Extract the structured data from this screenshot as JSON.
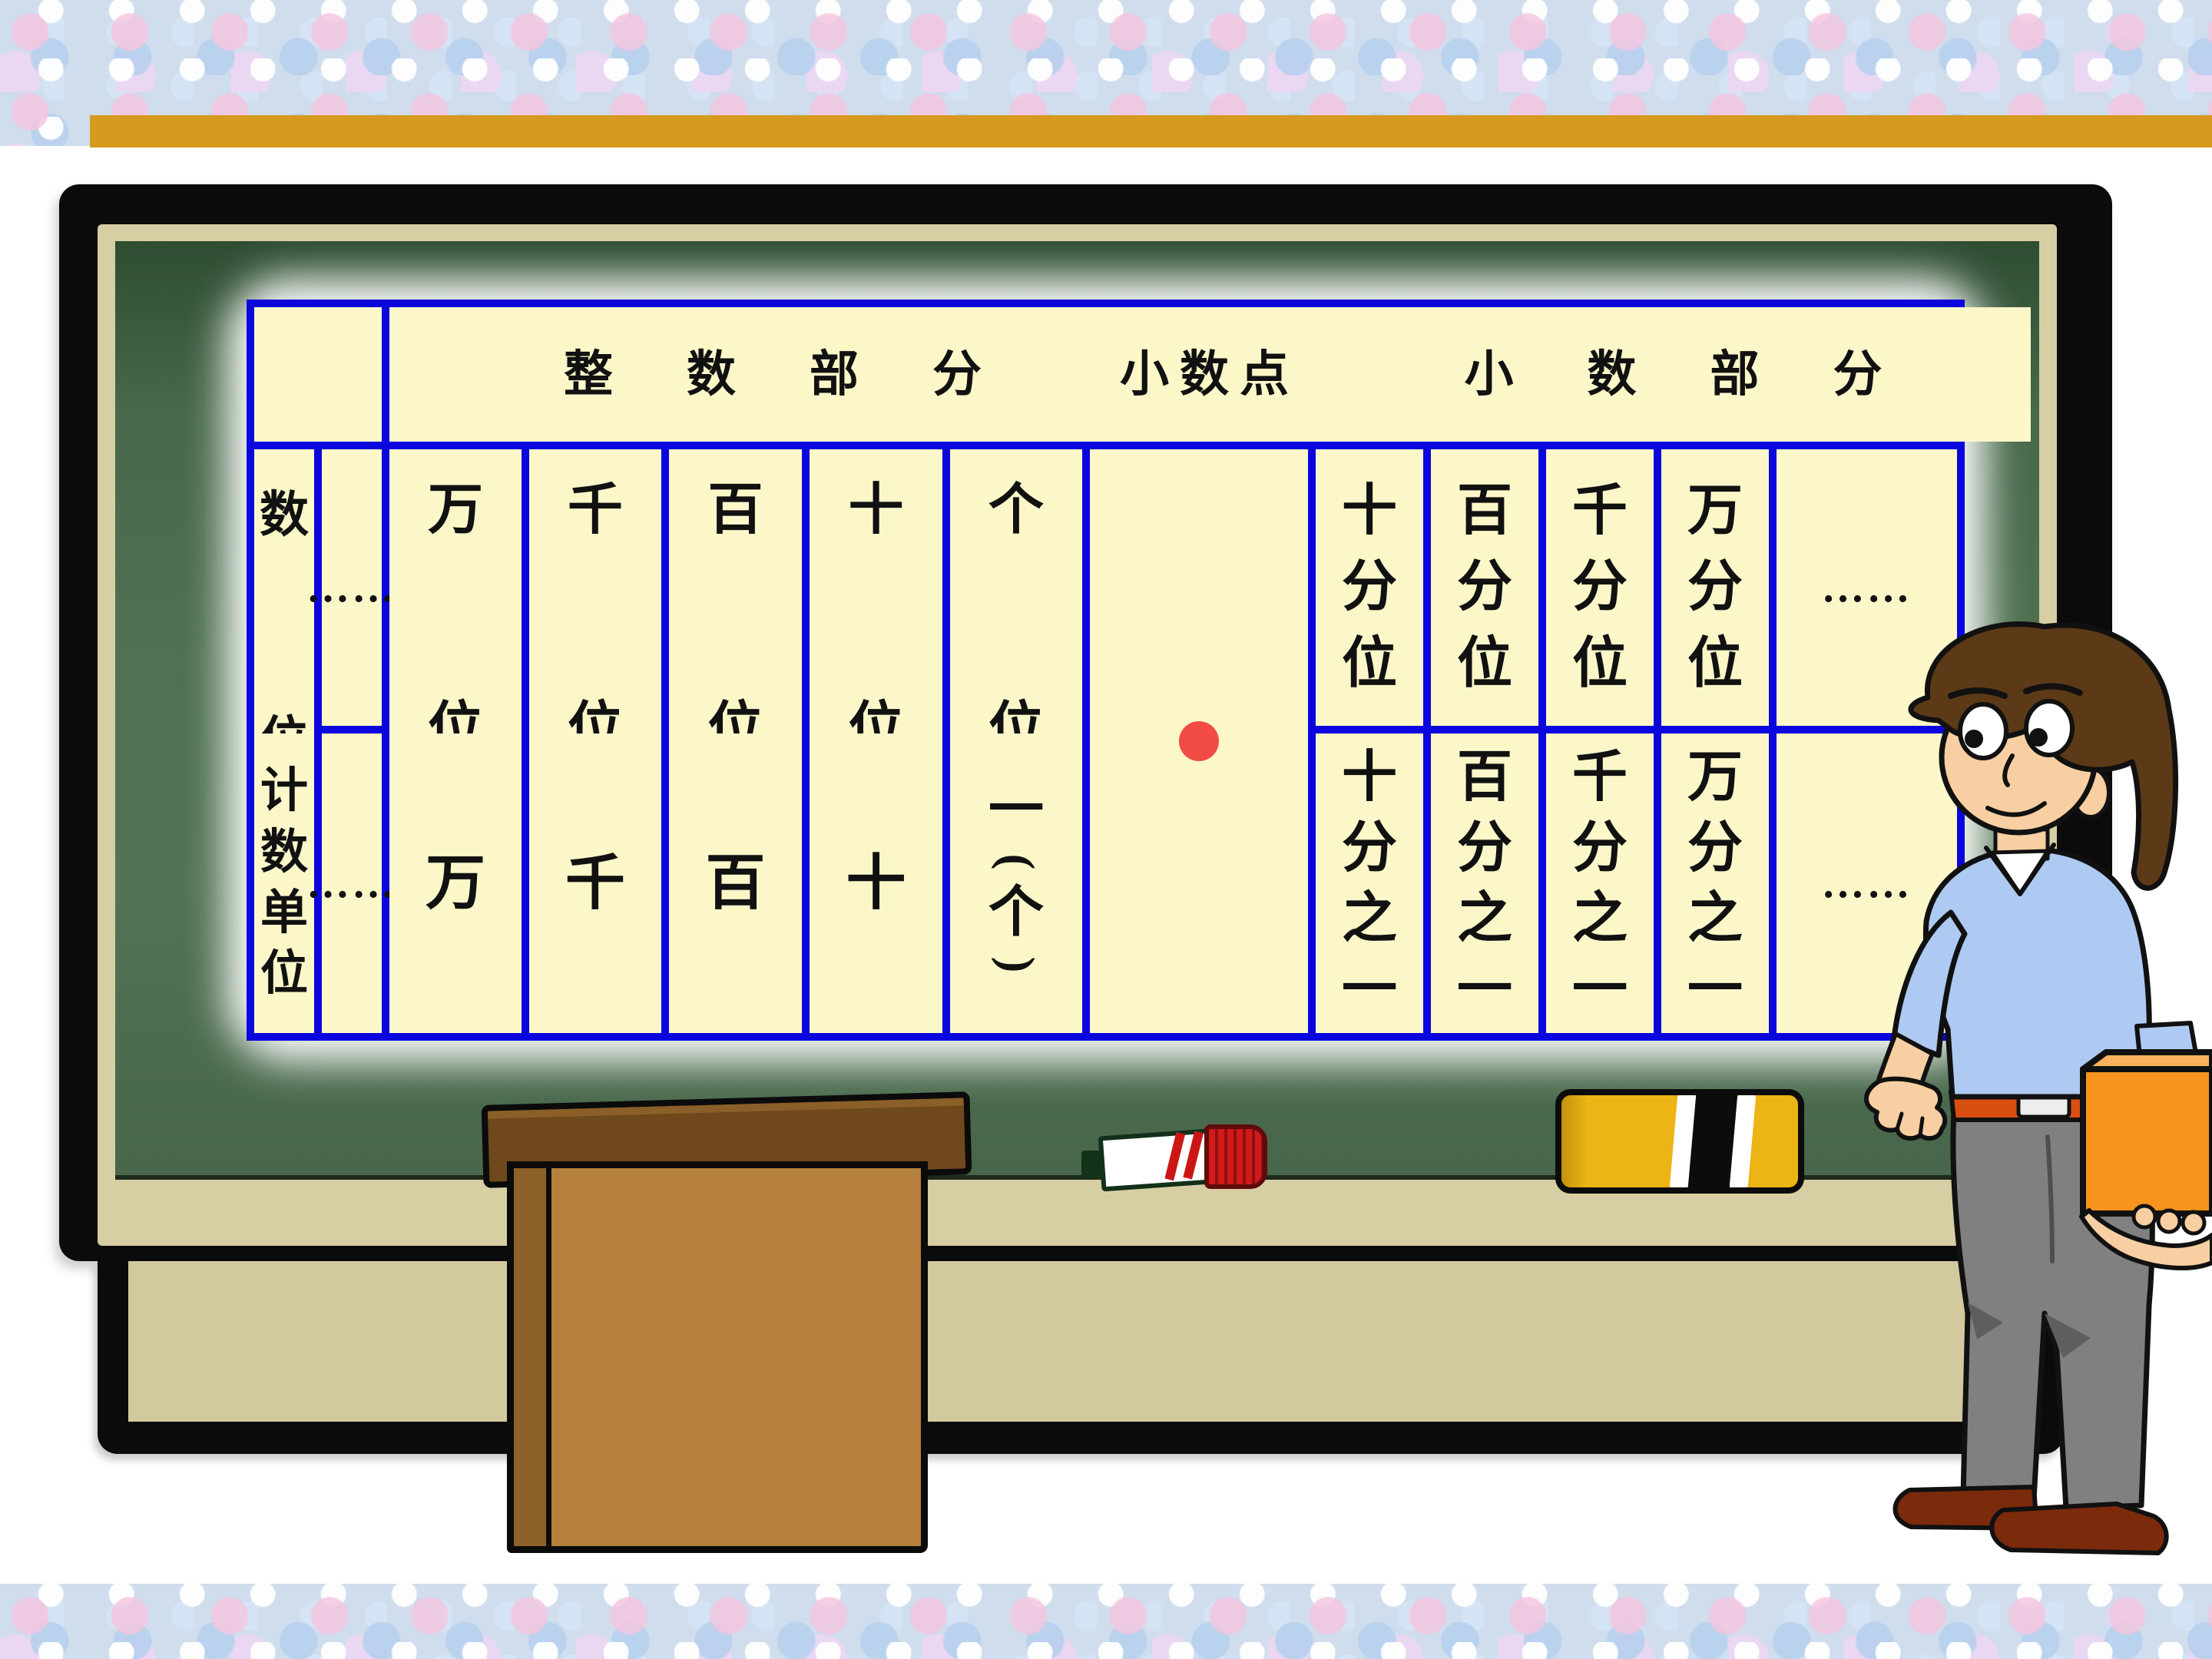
{
  "slide": {
    "accent_bar_color": "#d7991e",
    "background_pattern_base": "#cfdded"
  },
  "board": {
    "surface_color": "#4e7050",
    "frame_color": "#0b0b0b",
    "bevel_color": "#d8cea4",
    "table_background": "#fbf7c9",
    "grid_color": "#0b06dd",
    "decimal_dot_color": "#f24a45"
  },
  "table": {
    "headers": {
      "corner": "",
      "integer": "整数部分",
      "point": "小数点",
      "decimal": "小数部分"
    },
    "rows": [
      {
        "label": "数位",
        "integer_cells": [
          "……",
          "万位",
          "千位",
          "百位",
          "十位",
          "个位"
        ],
        "decimal_cells": [
          "十分位",
          "百分位",
          "千分位",
          "万分位",
          "……"
        ]
      },
      {
        "label": "计数单位",
        "integer_cells": [
          "……",
          "万",
          "千",
          "百",
          "十",
          "一(个)"
        ],
        "decimal_cells": [
          "十分之一",
          "百分之一",
          "千分之一",
          "万分之一",
          "……"
        ]
      }
    ],
    "decimal_point_symbol": "●"
  },
  "scene_objects": [
    "blackboard",
    "chalk-tray",
    "board-shelf",
    "podium",
    "marker",
    "board-eraser",
    "teacher-cartoon",
    "decimal-point-dot"
  ]
}
